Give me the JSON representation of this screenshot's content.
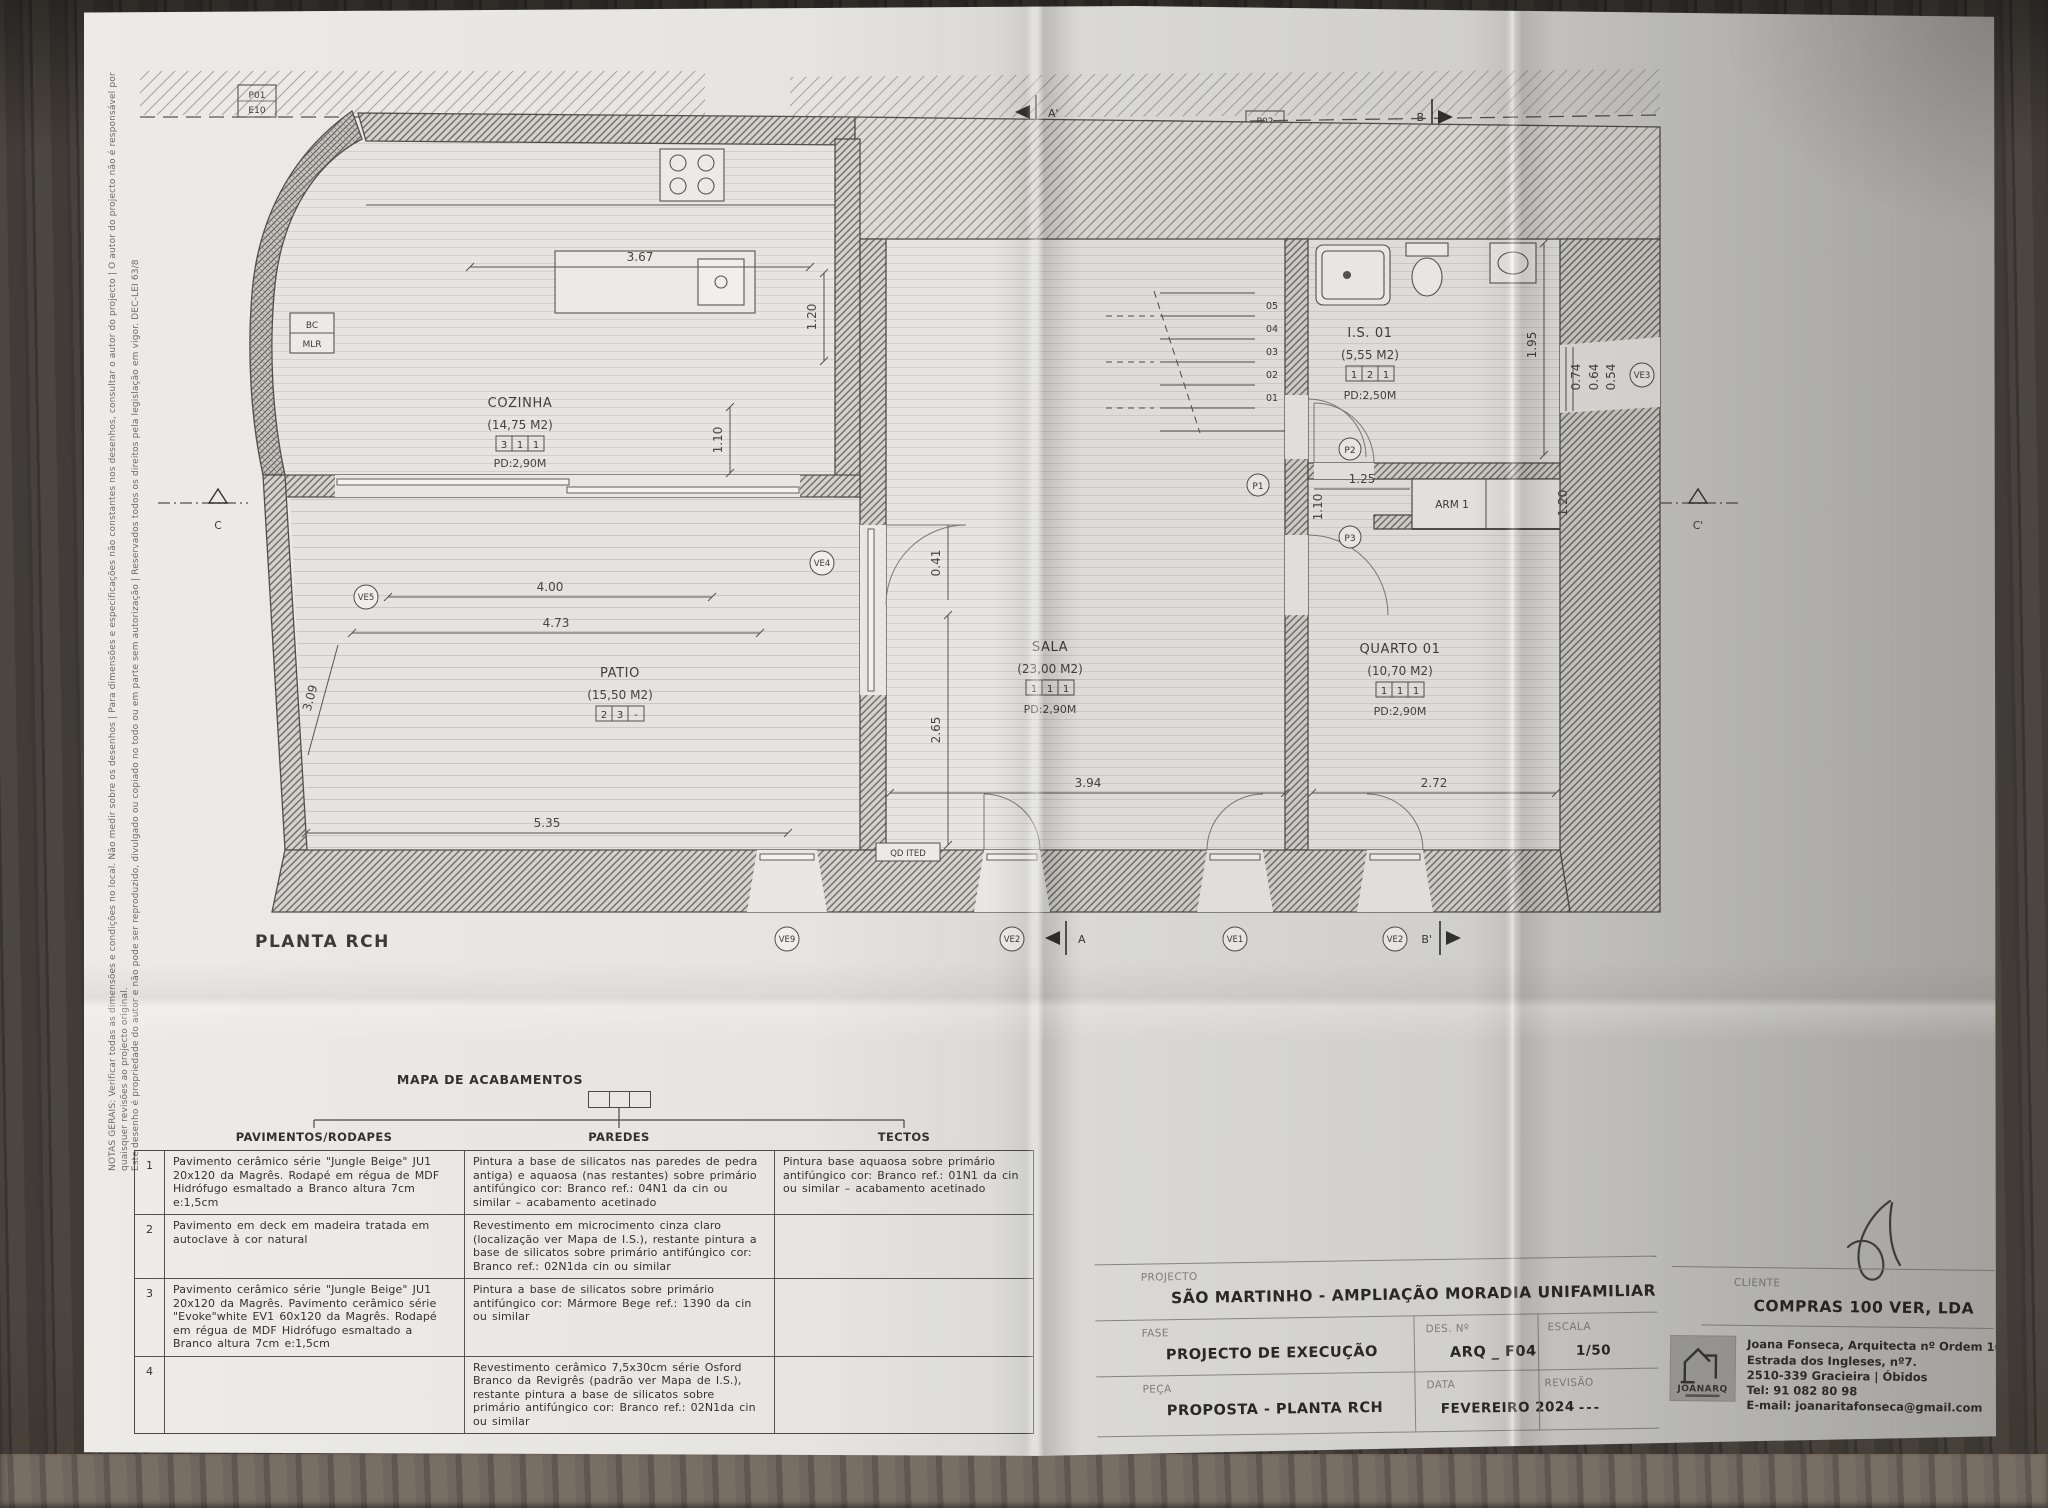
{
  "plan": {
    "label": "PLANTA RCH",
    "rooms": [
      {
        "name": "COZINHA",
        "area": "(14,75 M2)",
        "codes": [
          "3",
          "1",
          "1"
        ],
        "pd": "PD:2,90M"
      },
      {
        "name": "PATIO",
        "area": "(15,50 M2)",
        "codes": [
          "2",
          "3",
          "-"
        ],
        "pd": ""
      },
      {
        "name": "SALA",
        "area": "(23,00 M2)",
        "codes": [
          "1",
          "1",
          "1"
        ],
        "pd": "PD:2,90M"
      },
      {
        "name": "QUARTO 01",
        "area": "(10,70 M2)",
        "codes": [
          "1",
          "1",
          "1"
        ],
        "pd": "PD:2,90M"
      },
      {
        "name": "I.S. 01",
        "area": "(5,55 M2)",
        "codes": [
          "1",
          "2",
          "1"
        ],
        "pd": "PD:2,50M"
      }
    ],
    "arm_label": "ARM 1",
    "bc_label": "BC",
    "mlr_label": "MLR",
    "qd_label": "QD ITED",
    "stairs": [
      "05",
      "04",
      "03",
      "02",
      "01"
    ],
    "detail_markers": {
      "p01_line1": "P01",
      "p01_line2": "E10",
      "p02_line1": "P02",
      "p02_line2": "F11"
    },
    "door_markers": {
      "p1": "P1",
      "p2": "P2",
      "p3": "P3"
    },
    "window_markers": {
      "ve_bottom_1": "VE9",
      "ve_bottom_2": "VE2",
      "ve_bottom_3": "VE1",
      "ve_bottom_4": "VE2",
      "ve_right": "VE3",
      "ve_patio": "VE4",
      "ve_dim": "VE5"
    },
    "sections": {
      "a_top": "A'",
      "a_bottom": "A",
      "b_top": "B",
      "b_bottom": "B'",
      "c_left": "C",
      "c_right": "C'"
    },
    "dims": {
      "kitchen_w": "3.67",
      "kitchen_h": "1.20",
      "kitchen_island": "1.10",
      "patio_w1": "4.00",
      "patio_w2": "4.73",
      "patio_w3": "5.35",
      "patio_left": "3.09",
      "sala_glass": "2.65",
      "sala_wall": "0.41",
      "sala_w": "3.94",
      "quarto_w": "2.72",
      "is_h": "1.95",
      "win_a": "0.74",
      "win_b": "0.64",
      "win_c": "0.54",
      "corr_w": "1.25",
      "corr_h": "1.10",
      "arm_d": "1.20"
    }
  },
  "finishes": {
    "title": "MAPA DE ACABAMENTOS",
    "col_pavimentos": "PAVIMENTOS/RODAPES",
    "col_paredes": "PAREDES",
    "col_tectos": "TECTOS",
    "rows": [
      {
        "num": "1",
        "pavimentos": "Pavimento cerâmico série \"Jungle Beige\" JU1 20x120 da Magrês. Rodapé em régua de MDF Hidrófugo esmaltado a Branco altura 7cm e:1,5cm",
        "paredes": "Pintura a base de silicatos nas paredes de pedra antiga) e aquaosa (nas restantes) sobre primário antifúngico cor: Branco ref.: 04N1 da cin ou similar – acabamento acetinado",
        "tectos": "Pintura base aquaosa sobre primário antifúngico cor: Branco ref.: 01N1 da cin ou similar – acabamento acetinado"
      },
      {
        "num": "2",
        "pavimentos": "Pavimento em deck em madeira tratada em autoclave à cor natural",
        "paredes": "Revestimento em microcimento cinza claro (localização ver Mapa de I.S.), restante pintura a base de silicatos sobre primário antifúngico cor: Branco ref.: 02N1da cin ou similar",
        "tectos": ""
      },
      {
        "num": "3",
        "pavimentos": "Pavimento cerâmico série \"Jungle Beige\" JU1 20x120 da Magrês. Pavimento cerâmico série \"Evoke\"white EV1 60x120 da Magrês. Rodapé em régua de MDF Hidrófugo esmaltado a Branco altura 7cm e:1,5cm",
        "paredes": "Pintura a base de silicatos sobre primário antifúngico cor: Mármore Bege ref.: 1390 da cin ou similar",
        "tectos": ""
      },
      {
        "num": "4",
        "pavimentos": "",
        "paredes": "Revestimento cerâmico 7,5x30cm série Osford Branco da Revigrês (padrão ver Mapa de I.S.), restante pintura a base de silicatos sobre primário antifúngico cor: Branco ref.: 02N1da cin ou similar",
        "tectos": ""
      }
    ]
  },
  "title_block": {
    "projecto_label": "PROJECTO",
    "projecto": "SÃO MARTINHO  -  AMPLIAÇÃO  MORADIA UNIFAMILIAR",
    "fase_label": "FASE",
    "fase": "PROJECTO DE EXECUÇÃO",
    "peca_label": "PEÇA",
    "peca": "PROPOSTA - PLANTA RCH",
    "des_label": "DES. Nº",
    "des": "ARQ _ F04",
    "data_label": "DATA",
    "data": "FEVEREIRO 2024",
    "escala_label": "ESCALA",
    "escala": "1/50",
    "revisao_label": "REVISÃO",
    "revisao": "---",
    "cliente_label": "CLIENTE",
    "cliente": "COMPRAS 100 VER, LDA",
    "architect": {
      "logo": "JOANARQ",
      "lines": [
        "Joana Fonseca, Arquitecta nº Ordem 16595",
        "Estrada dos Ingleses, nº7.",
        "2510-339 Gracieira | Óbidos",
        "Tel: 91 082 80 98",
        "E-mail: joanaritafonseca@gmail.com"
      ]
    }
  },
  "notes": {
    "line1": "NOTAS GERAIS: Verificar todas as dimensões e condições no local. Não medir sobre os desenhos | Para dimensões e especificações não constantes nos desenhos, consultar o autor do projecto | O autor do projecto não é responsável por quaisquer revisões ao projecto original.",
    "line2": "Este desenho é propriedade do autor e não pode ser reproduzido, divulgado ou copiado no todo ou em parte sem autorização | Reservados todos os direitos pela legislação em vigor. DEC-LEI 63/8"
  }
}
